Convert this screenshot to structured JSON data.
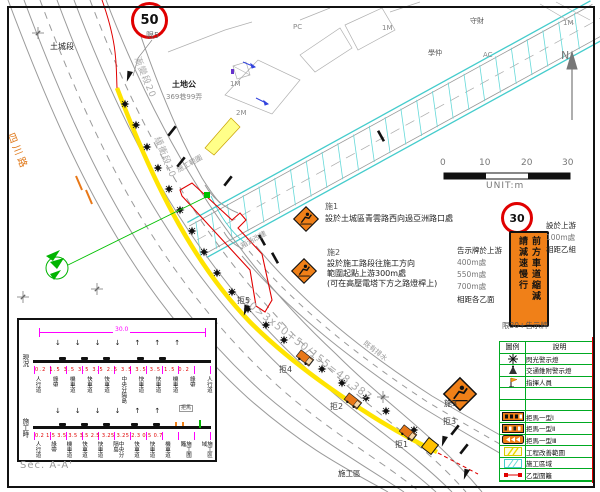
{
  "drawing": {
    "speed50": "50",
    "speed30": "30",
    "north": "N",
    "scale_ticks": [
      "0",
      "10",
      "20",
      "30"
    ],
    "scale_unit": "UNIT:m",
    "narrow_sign_col_right": "前方車道縮減",
    "narrow_sign_col_left": "請減速慢行",
    "narrow_sign_caption": "限30+告示牌"
  },
  "notes": {
    "s1_tag": "施1",
    "s1_text": "設於土城區青雲路西向過亞洲路口處",
    "s2_tag": "施2",
    "s2_line1": "設於施工路段往施工方向",
    "s2_line2": "範圍起點上游300m處",
    "s2_line3": "(可在高壓電塔下方之路燈桿上)",
    "board_l1": "告示牌於上游",
    "board_l2": "400m處",
    "board_l3": "550m處",
    "board_l4": "700m處",
    "board_l5": "相距各乙面",
    "right_l1": "設於上游",
    "right_l2": "100m處",
    "right_l3": "相距乙組",
    "s3_tag": "施3",
    "limit5_tag": "限5"
  },
  "map": {
    "road_name": "四川路",
    "section_name": "土城段",
    "temple": "土地公",
    "address": "369巷99弄",
    "taper20": "漸變段20",
    "buffer10": "緩衝段10",
    "station_eq": "50>3x50+50/155=48.387",
    "culvert1": "施工範圍",
    "culvert2": "箱涵改建",
    "drain": "既有排水",
    "work_area": "施工區",
    "pc": "PC",
    "m1a": "1M",
    "m1b": "1M",
    "m1c": "1M",
    "m2": "2M",
    "ac": "AC",
    "nm1": "守財",
    "nm2": "學仲",
    "j1": "拒1",
    "j2": "拒2",
    "j3": "拒3",
    "j4": "拒4",
    "j5": "拒5"
  },
  "legend": {
    "col_symbol": "圖例",
    "col_desc": "說明",
    "rows": [
      {
        "label": "閃光警示燈"
      },
      {
        "label": "交通錐附警示燈"
      },
      {
        "label": "指揮人員"
      },
      {
        "label": ""
      },
      {
        "label": ""
      },
      {
        "label": "拒馬一型Ⅰ"
      },
      {
        "label": "拒馬一型Ⅱ"
      },
      {
        "label": "拒馬一型Ⅲ"
      },
      {
        "label": "工程改善範圍"
      },
      {
        "label": "施工區域"
      },
      {
        "label": "乙型圍籬"
      }
    ]
  },
  "section": {
    "caption": "Sec. A-A'",
    "total_width": "30.0",
    "row1_label": "現況",
    "row2_label": "施工時",
    "row1_dims": "0.2 1.5 3.5 3.5 3.5 2.5 3.5 3.5 3.5 1.5 0.2",
    "row2_dims": "0.2 1.5 3.5 3.5 3.5 2.5 3.25 3.25 2.3 0.5 0.7",
    "row1_names": [
      "人行道",
      "綠帶",
      "機車道",
      "快車道",
      "快車道",
      "中央分隔島",
      "快車道",
      "快車道",
      "機車道",
      "綠帶",
      "人行道"
    ],
    "row2_names": [
      "人行道",
      "綠帶",
      "機車道",
      "快車道",
      "快車道",
      "中央分隔島",
      "快車道",
      "快車道",
      "機車道",
      "施工圍籬",
      "施工區域"
    ],
    "barricade_tag": "拒馬"
  },
  "colors": {
    "work_orange": "#f08018",
    "cone_yellow": "#ffe400",
    "canal_cyan": "#44cccc",
    "legend_green": "#00aa22",
    "dim_magenta": "#ff00ff",
    "alert_red": "#e00000"
  }
}
